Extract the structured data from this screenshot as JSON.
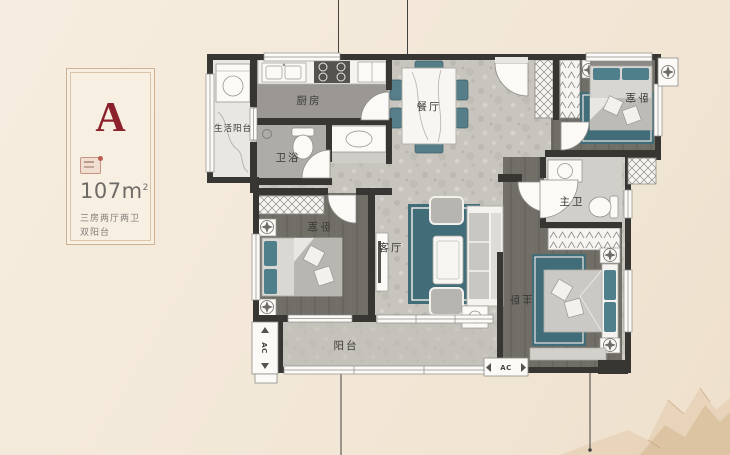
{
  "card": {
    "unit_label": "A",
    "area_number": "107",
    "area_unit": "m",
    "area_sup": "2",
    "tagline_1": "三房两厅两卫",
    "tagline_2": "双阳台"
  },
  "floorplan": {
    "labels": {
      "kitchen": "厨房",
      "service_balcony": "生活阳台",
      "bath": "卫浴",
      "dining": "餐厅",
      "living": "客厅",
      "bedroom_left": "卧室",
      "bedroom_right": "卧室",
      "master_bath": "主卫",
      "master_bedroom": "主卧",
      "balcony": "阳台",
      "ac": "AC"
    }
  },
  "colors": {
    "accent_red": "#8c212b",
    "wall": "#383633",
    "teal_rug": "#416d79",
    "teal_pillow": "#4f7f8b",
    "background_cream": "#f2e7d7",
    "card_border_tan": "#cdb192"
  }
}
